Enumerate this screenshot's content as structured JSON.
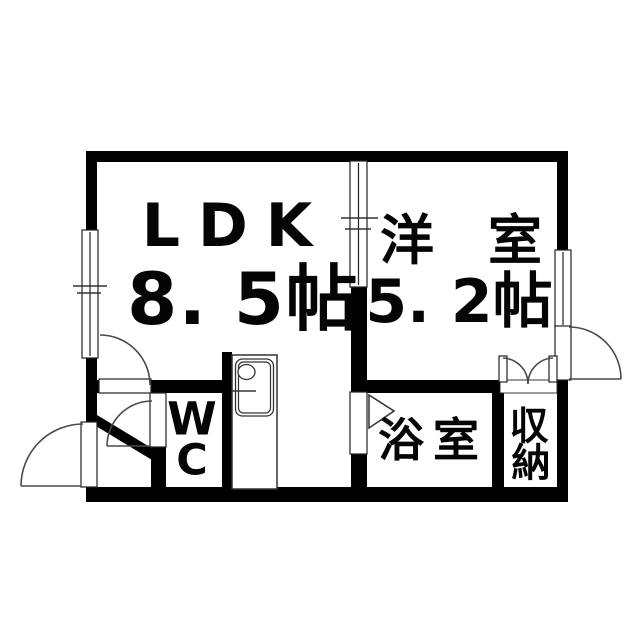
{
  "meta": {
    "type": "floorplan",
    "background_color": "#ffffff",
    "wall_color": "#000000",
    "thin_line_color": "#4a4a4a"
  },
  "rooms": {
    "ldk": {
      "name": "LDK",
      "size": "8. 5帖"
    },
    "western": {
      "name": "洋　室",
      "size": "5. 2帖"
    },
    "wc": {
      "name": "WC",
      "chars": [
        "W",
        "C"
      ]
    },
    "bath": {
      "name": "浴室"
    },
    "storage": {
      "name": "収納",
      "chars": [
        "収",
        "納"
      ]
    }
  },
  "symbols": [
    "entrance-swing-door",
    "entrance-step-diagonal-wall",
    "ldk-swing-door",
    "wc-swing-door",
    "bath-folding-door-triangle",
    "kitchen-sink-counter",
    "ldk-partition-sliding-window",
    "left-wall-sliding-window",
    "right-wall-sliding-window",
    "balcony-swing-door",
    "closet-double-swing-doors"
  ]
}
